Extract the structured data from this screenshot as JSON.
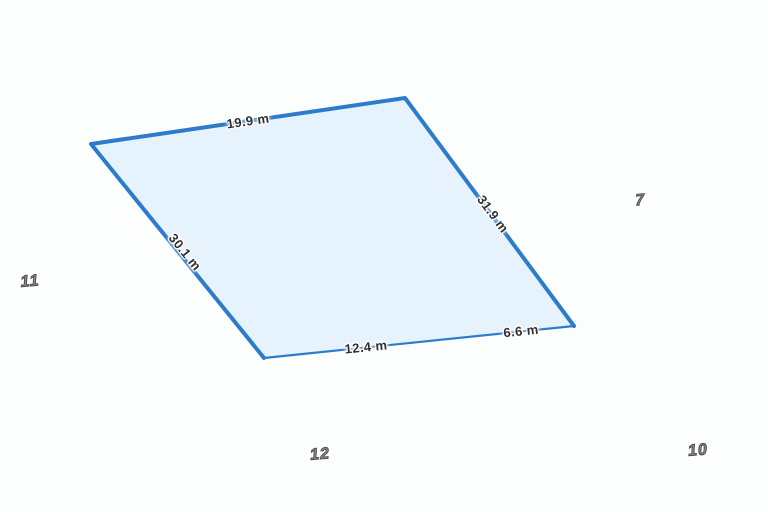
{
  "map": {
    "type": "property-boundary-map",
    "background_color": "#fcfdfd",
    "selected_parcel": {
      "fill_color": "#e6f2fc",
      "stroke_color": "#2d7ccc",
      "dimensions": [
        {
          "edge": "top",
          "text": "19.9 m"
        },
        {
          "edge": "left",
          "text": "30.1 m"
        },
        {
          "edge": "right",
          "text": "31.9 m"
        },
        {
          "edge": "bottom-left",
          "text": "12.4 m"
        },
        {
          "edge": "bottom-right",
          "text": "6.6 m"
        }
      ]
    },
    "lot_numbers": [
      {
        "position": "left",
        "text": "11"
      },
      {
        "position": "right",
        "text": "7"
      },
      {
        "position": "bottom-center",
        "text": "12"
      },
      {
        "position": "bottom-right",
        "text": "10"
      }
    ],
    "dimension_label_color": "#2f2f2f",
    "lot_number_color": "#8f8f8f"
  }
}
